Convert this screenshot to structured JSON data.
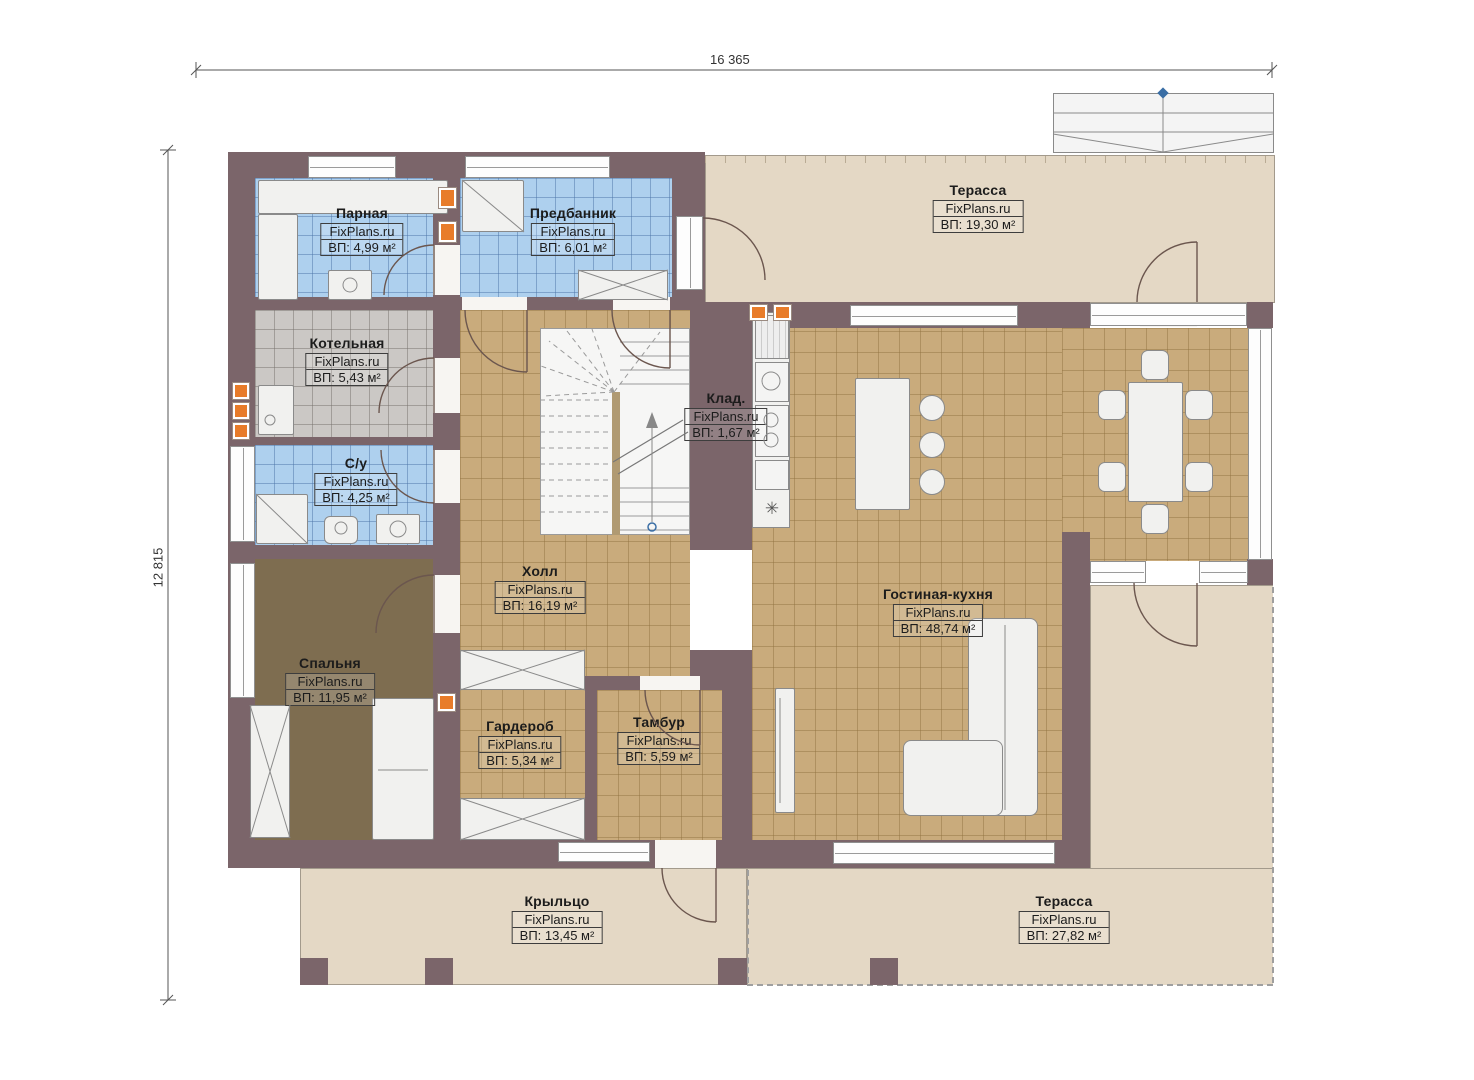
{
  "plan": {
    "brand": "FixPlans.ru",
    "dimensions": {
      "top": "16 365",
      "left": "12 815"
    },
    "rooms": [
      {
        "name": "Парная",
        "area": "ВП: 4,99 м²"
      },
      {
        "name": "Предбанник",
        "area": "ВП: 6,01 м²"
      },
      {
        "name": "Терасса",
        "area": "ВП: 19,30 м²"
      },
      {
        "name": "Котельная",
        "area": "ВП: 5,43 м²"
      },
      {
        "name": "Клад.",
        "area": "ВП: 1,67 м²"
      },
      {
        "name": "С/у",
        "area": "ВП: 4,25 м²"
      },
      {
        "name": "Холл",
        "area": "ВП: 16,19 м²"
      },
      {
        "name": "Гостиная-кухня",
        "area": "ВП: 48,74 м²"
      },
      {
        "name": "Спальня",
        "area": "ВП: 11,95 м²"
      },
      {
        "name": "Гардероб",
        "area": "ВП: 5,34 м²"
      },
      {
        "name": "Тамбур",
        "area": "ВП: 5,59 м²"
      },
      {
        "name": "Крыльцо",
        "area": "ВП: 13,45 м²"
      },
      {
        "name": "Терасса",
        "area": "ВП: 27,82 м²"
      }
    ],
    "symbols": {
      "stove_mark": "✳"
    },
    "colors": {
      "wall": "#7b656a",
      "tile_tan": "#c9ab7c",
      "tile_blue": "#aed0ee",
      "tile_gray": "#cbc8c5",
      "bedroom_floor": "#7e6d50",
      "terrace": "#e4d8c5",
      "vent_orange": "#e87c2a",
      "marker_blue": "#3a6ea5"
    }
  }
}
